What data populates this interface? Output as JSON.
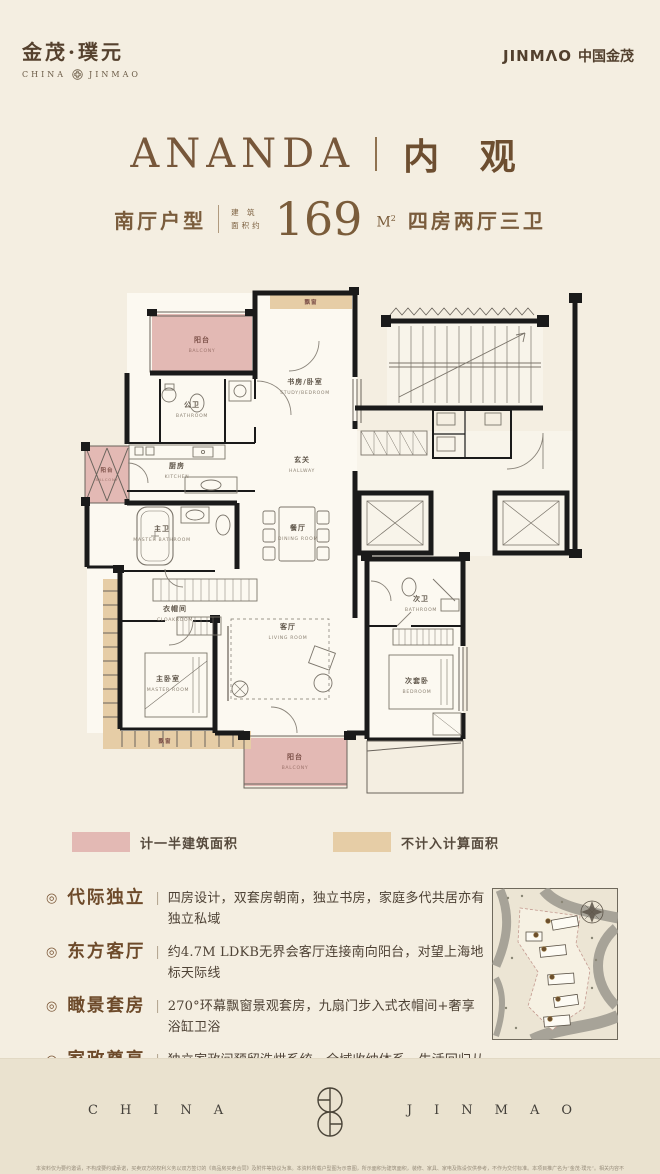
{
  "colors": {
    "background": "#f4eee1",
    "footer_band": "#eae2cf",
    "accent_brown": "#77573a",
    "half_area_pink": "#e3b9b4",
    "excluded_tan": "#e6cda6",
    "wall_black": "#1a1a1a"
  },
  "header": {
    "brand_left_cn": "金茂·璞元",
    "brand_left_en_left": "CHINA",
    "brand_left_en_right": "JINMAO",
    "brand_right_en": "JINMΛO",
    "brand_right_cn": "中国金茂"
  },
  "title": {
    "en": "ANANDA",
    "cn": "内 观"
  },
  "subtitle": {
    "layout": "南厅户型",
    "area_label_1": "建 筑",
    "area_label_2": "面积约",
    "area_value": "169",
    "area_unit": "M",
    "area_unit_sup": "2",
    "rooms": "四房两厅三卫"
  },
  "plan": {
    "rooms": [
      {
        "cn": "阳台",
        "en": "BALCONY"
      },
      {
        "cn": "飘窗",
        "en": ""
      },
      {
        "cn": "书房/卧室",
        "en": "STUDY/BEDROOM"
      },
      {
        "cn": "公卫",
        "en": "BATHROOM"
      },
      {
        "cn": "厨房",
        "en": "KITCHEN"
      },
      {
        "cn": "玄关",
        "en": "HALLWAY"
      },
      {
        "cn": "阳台",
        "en": "BALCONY"
      },
      {
        "cn": "主卫",
        "en": "MASTER BATHROOM"
      },
      {
        "cn": "衣帽间",
        "en": "CLOAKROOM"
      },
      {
        "cn": "餐厅",
        "en": "DINING ROOM"
      },
      {
        "cn": "客厅",
        "en": "LIVING ROOM"
      },
      {
        "cn": "主卧室",
        "en": "MASTER ROOM"
      },
      {
        "cn": "飘窗",
        "en": ""
      },
      {
        "cn": "次卫",
        "en": "BATHROOM"
      },
      {
        "cn": "次套卧",
        "en": "BEDROOM"
      },
      {
        "cn": "阳台",
        "en": "BALCONY"
      }
    ]
  },
  "legend": {
    "items": [
      {
        "label": "计一半建筑面积",
        "color": "#e3b9b4"
      },
      {
        "label": "不计入计算面积",
        "color": "#e6cda6"
      }
    ]
  },
  "features": {
    "marker": "◎",
    "divider": "|",
    "items": [
      {
        "title": "代际独立",
        "desc": "四房设计，双套房朝南，独立书房，家庭多代共居亦有独立私域"
      },
      {
        "title": "东方客厅",
        "desc": "约4.7M LDKB无界会客厅连接南向阳台，对望上海地标天际线"
      },
      {
        "title": "瞰景套房",
        "desc": "270°环幕飘窗景观套房，九扇门步入式衣帽间+奢享浴缸卫浴"
      },
      {
        "title": "家政尊享",
        "desc": "独立家政间预留洗烘系统，全域收纳体系，生活回归从容优雅"
      },
      {
        "title": "奢装智境",
        "desc": "五舒十二大科技，嘉格纳、劳芬、当代名品集萃，引领科技质居"
      }
    ]
  },
  "footer": {
    "china": "CHINA",
    "jinmao": "JINMAO"
  },
  "disclaimer": "本资料仅为要约邀请，不构成要约或承诺，买卖双方的权利义务以双方签订的《商品房买卖合同》及附件等协议为准。本资料所载户型图为示意图，所示面积为建筑面积，装修、家具、家电及陈设仅供参考，不作为交付标准。本项目推广名为“金茂·璞元”。相关内容不排除因政府相关规划、规定及出卖人未能控制的原因而发生变化，出卖人保留对宣传资料进行修改的权利，敬请留意最新资料。"
}
